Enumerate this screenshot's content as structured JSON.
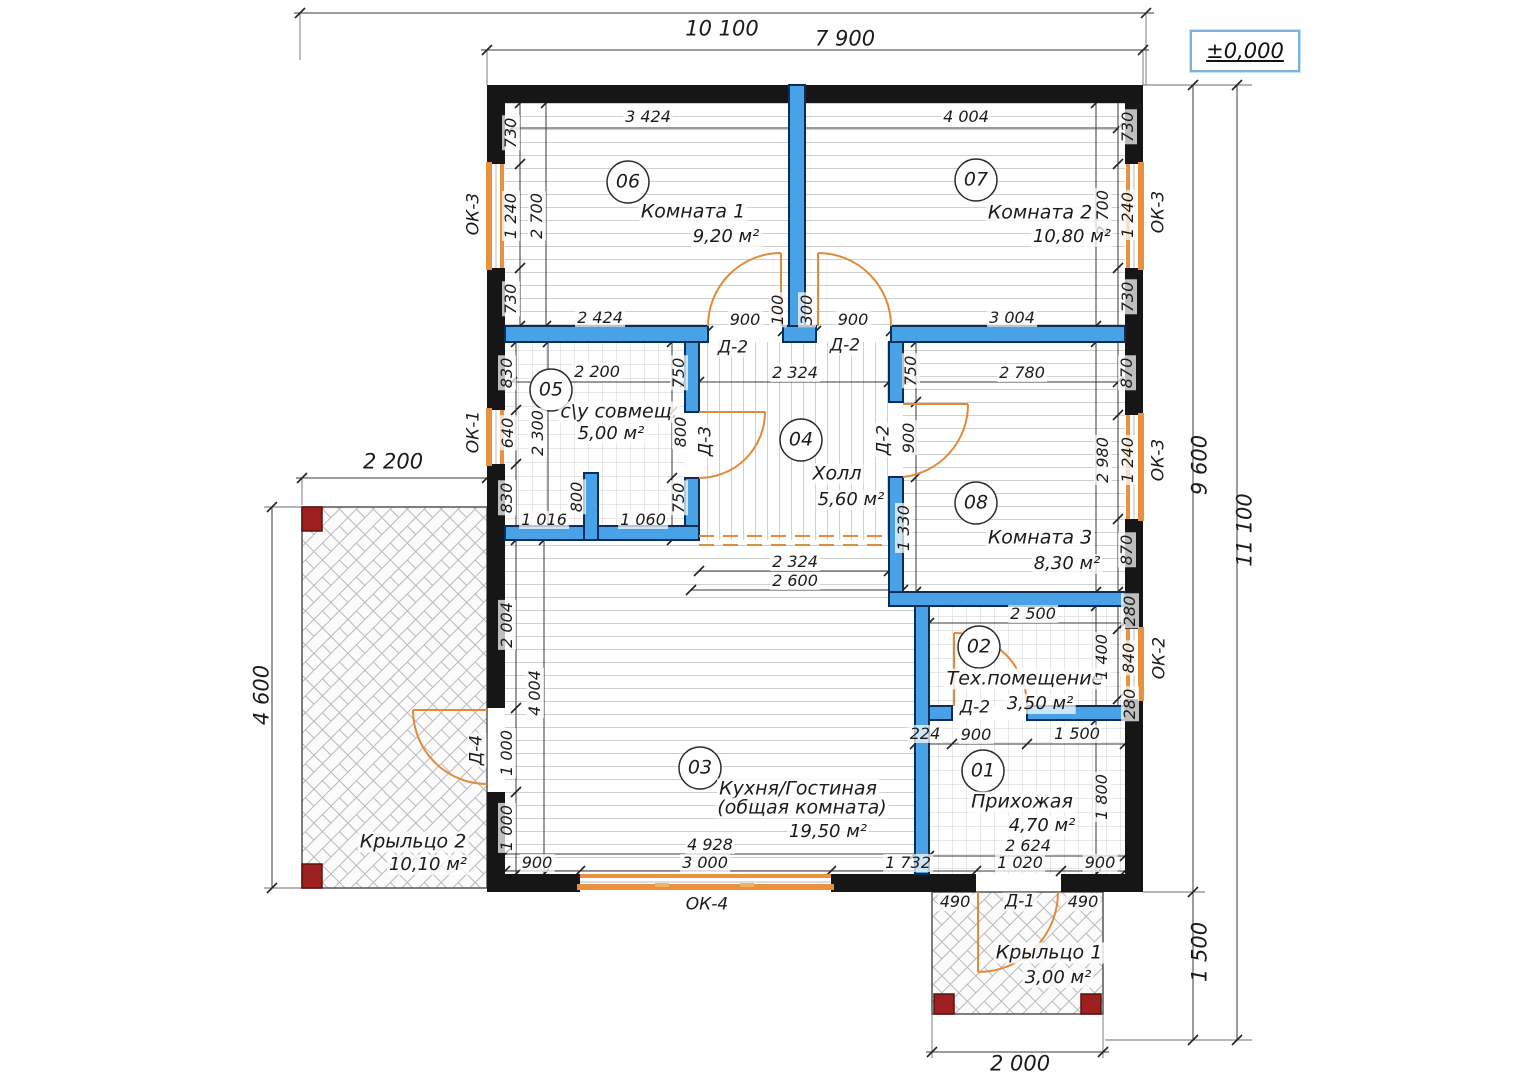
{
  "elevation_label": "±0,000",
  "rooms": [
    {
      "number": "01",
      "name": "Прихожая",
      "area": "4,70 м²"
    },
    {
      "number": "02",
      "name": "Тех.помещение",
      "area": "3,50 м²"
    },
    {
      "number": "03",
      "name": "Кухня/Гостиная",
      "name2": "(общая комната)",
      "area": "19,50 м²"
    },
    {
      "number": "04",
      "name": "Холл",
      "area": "5,60 м²"
    },
    {
      "number": "05",
      "name": "с\\у совмещ.",
      "area": "5,00 м²"
    },
    {
      "number": "06",
      "name": "Комната 1",
      "area": "9,20 м²"
    },
    {
      "number": "07",
      "name": "Комната 2",
      "area": "10,80 м²"
    },
    {
      "number": "08",
      "name": "Комната 3",
      "area": "8,30 м²"
    }
  ],
  "porches": [
    {
      "name": "Крыльцо 1",
      "area": "3,00 м²"
    },
    {
      "name": "Крыльцо 2",
      "area": "10,10 м²"
    }
  ],
  "windows": {
    "ok1": "ОК-1",
    "ok2": "ОК-2",
    "ok3": "ОК-3",
    "ok4": "ОК-4"
  },
  "doors": {
    "d1": "Д-1",
    "d2": "Д-2",
    "d3": "Д-3",
    "d4": "Д-4"
  },
  "dims": {
    "overall_w": "10 100",
    "inner_w": "7 900",
    "r06_top": "3 424",
    "r07_top": "4 004",
    "k730": "730",
    "k1240": "1 240",
    "k2700": "2 700",
    "k900": "900",
    "k100": "100",
    "k300": "300",
    "k2424": "2 424",
    "k3004": "3 004",
    "k2200": "2 200",
    "k2324": "2 324",
    "k2780": "2 780",
    "k830": "830",
    "k640": "640",
    "k2300": "2 300",
    "k750": "750",
    "k800": "800",
    "k1016": "1 016",
    "k1060": "1 060",
    "k870": "870",
    "k2980": "2 980",
    "k1330": "1 330",
    "k2600": "2 600",
    "k2500": "2 500",
    "k1400": "1 400",
    "k280": "280",
    "k840": "840",
    "k224": "224",
    "k1500": "1 500",
    "k2004": "2 004",
    "k4004": "4 004",
    "k1000": "1 000",
    "k1800": "1 800",
    "k2624": "2 624",
    "k1732": "1 732",
    "k1020": "1 020",
    "k490": "490",
    "k4928": "4 928",
    "k3000": "3 000",
    "k9600": "9 600",
    "k11100": "11 100",
    "k4600": "4 600",
    "k2000": "2 000"
  },
  "colors": {
    "interior_wall": "#49a1e6",
    "exterior_wall": "#161616",
    "window": "#e8913f",
    "door": "#e08b3c",
    "post": "#9e1f1f",
    "elevation_border": "#79b2e2"
  }
}
